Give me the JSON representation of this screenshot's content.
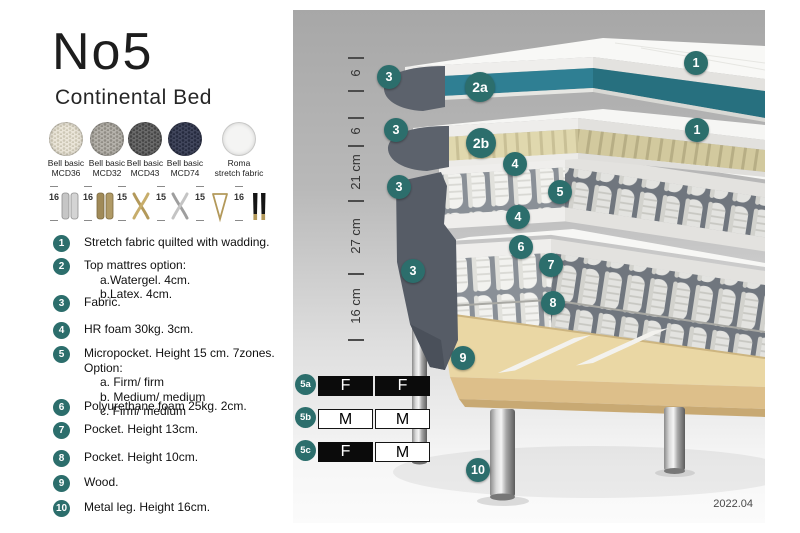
{
  "header": {
    "title": "No5",
    "subtitle": "Continental Bed"
  },
  "fabrics": [
    {
      "name": "Bell basic",
      "code": "MCD36"
    },
    {
      "name": "Bell basic",
      "code": "MCD32"
    },
    {
      "name": "Bell basic",
      "code": "MCD43"
    },
    {
      "name": "Bell basic",
      "code": "MCD74"
    },
    {
      "name": "Roma",
      "code": "stretch fabric"
    }
  ],
  "legs": [
    {
      "height": "16",
      "type": "cylinder-silver"
    },
    {
      "height": "16",
      "type": "cylinder-brass"
    },
    {
      "height": "15",
      "type": "cross-gold"
    },
    {
      "height": "15",
      "type": "cross-silver"
    },
    {
      "height": "15",
      "type": "hairpin-gold"
    },
    {
      "height": "16",
      "type": "tapered-black-gold"
    }
  ],
  "spec_list": [
    {
      "num": "1",
      "text": "Stretch fabric quilted with wadding."
    },
    {
      "num": "2",
      "text": "Top mattres option:",
      "sub": [
        "a.Watergel. 4cm.",
        "b.Latex. 4cm."
      ]
    },
    {
      "num": "3",
      "text": "Fabric."
    },
    {
      "num": "4",
      "text": "HR foam 30kg. 3cm."
    },
    {
      "num": "5",
      "text": "Micropocket. Height 15 cm. 7zones. Option:",
      "sub": [
        "a. Firm/ firm",
        "b. Medium/ medium",
        "c. Firm/ medium"
      ]
    },
    {
      "num": "6",
      "text": "Polyurethane foam 25kg. 2cm."
    },
    {
      "num": "7",
      "text": "Pocket. Height 13cm."
    },
    {
      "num": "8",
      "text": "Pocket. Height 10cm."
    },
    {
      "num": "9",
      "text": "Wood."
    },
    {
      "num": "10",
      "text": "Metal leg. Height 16cm."
    }
  ],
  "diagram": {
    "ruler_labels": [
      "6",
      "6",
      "21 cm",
      "27 cm",
      "16 cm"
    ],
    "badges": [
      "1",
      "3",
      "2a",
      "1",
      "3",
      "2b",
      "4",
      "5",
      "3",
      "4",
      "6",
      "3",
      "7",
      "8",
      "9",
      "10"
    ],
    "firmness": [
      {
        "label": "5a",
        "c1": "F",
        "c1_style": "dark",
        "c2": "F",
        "c2_style": "dark"
      },
      {
        "label": "5b",
        "c1": "M",
        "c1_style": "light",
        "c2": "M",
        "c2_style": "light"
      },
      {
        "label": "5c",
        "c1": "F",
        "c1_style": "dark",
        "c2": "M",
        "c2_style": "light"
      }
    ],
    "version": "2022.04"
  },
  "colors": {
    "badge_teal": "#2c6e6c",
    "watergel_teal": "#2f7f93",
    "latex_beige": "#e0d8ae",
    "dark_fabric": "#565c66",
    "wood": "#ead7a4",
    "swatch_mcd36": "#eae5d8",
    "swatch_mcd32": "#b5b2ab",
    "swatch_mcd43": "#6a6a6a",
    "swatch_mcd74": "#41465c",
    "swatch_roma": "#f4f4f3"
  }
}
